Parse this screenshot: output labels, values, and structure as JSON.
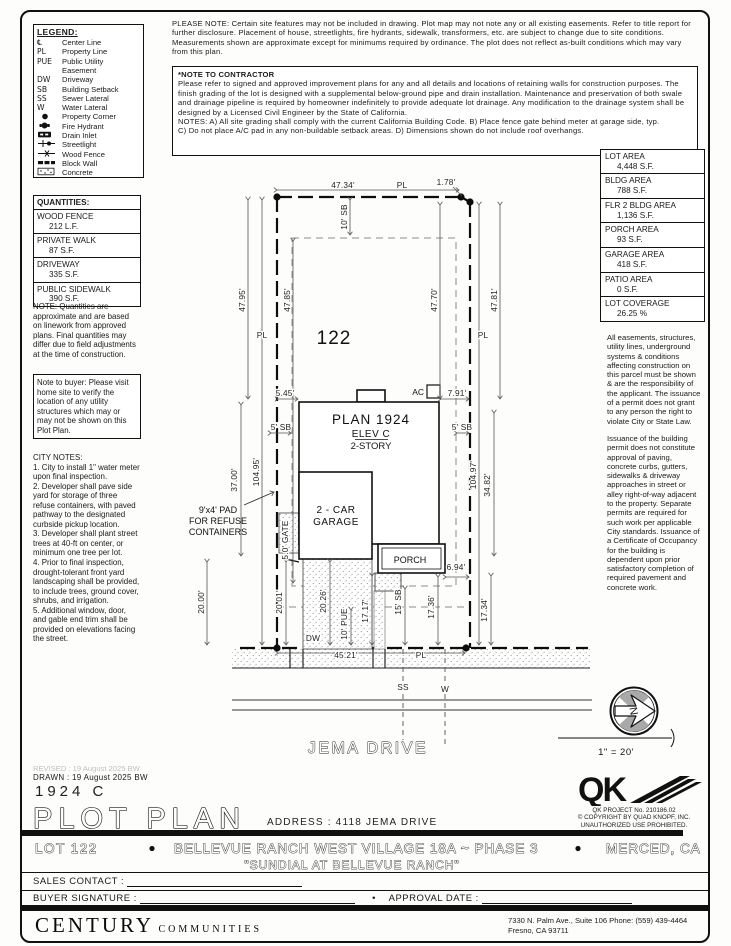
{
  "header": {
    "please_note": "PLEASE NOTE:  Certain site features may not be included in drawing. Plot map may not note any or all existing easements. Refer to title report for further disclosure. Placement of house, streetlights, fire hydrants, sidewalk, transformers, etc. are subject to change due to site conditions. Measurements shown are approximate except for minimums required by ordinance. The plot does not reflect as-built conditions which may vary from this plan.",
    "contractor_note_title": "*NOTE TO CONTRACTOR",
    "contractor_note": "Please refer to signed and approved improvement plans for any and all details and locations of retaining walls for construction purposes. The finish grading of the lot is designed with a supplemental below-ground pipe and drain installation. Maintenance and preservation of both swale and drainage pipeline is required by homeowner indefinitely to provide adequate lot drainage. Any modification to the drainage system shall be designed by a Licensed Civil Engineer by the State of California.\nNOTES:  A) All site grading shall comply with the current California Building Code.  B) Place fence gate behind meter at garage side, typ.\nC) Do not place A/C pad in any non-buildable setback areas.  D) Dimensions shown do not include roof overhangs."
  },
  "legend": {
    "title": "LEGEND:",
    "items": [
      {
        "symbol": "℄",
        "label": "Center Line"
      },
      {
        "symbol": "PL",
        "label": "Property Line"
      },
      {
        "symbol": "PUE",
        "label": "Public Utility\nEasement"
      },
      {
        "symbol": "DW",
        "label": "Driveway"
      },
      {
        "symbol": "SB",
        "label": "Building Setback"
      },
      {
        "symbol": "SS",
        "label": "Sewer Lateral"
      },
      {
        "symbol": "W",
        "label": "Water Lateral"
      },
      {
        "symbol": "",
        "label": "Property Corner"
      },
      {
        "symbol": "",
        "label": "Fire Hydrant"
      },
      {
        "symbol": "",
        "label": "Drain Inlet"
      },
      {
        "symbol": "",
        "label": "Streetlight"
      },
      {
        "symbol": "",
        "label": "Wood Fence"
      },
      {
        "symbol": "",
        "label": "Block Wall"
      },
      {
        "symbol": "",
        "label": "Concrete"
      }
    ]
  },
  "quantities": {
    "title": "QUANTITIES:",
    "items": [
      {
        "label": "WOOD FENCE",
        "value": "212 L.F."
      },
      {
        "label": "PRIVATE WALK",
        "value": "87 S.F."
      },
      {
        "label": "DRIVEWAY",
        "value": "335 S.F."
      },
      {
        "label": "PUBLIC SIDEWALK",
        "value": "390 S.F."
      }
    ],
    "note": "NOTE:  Quantities are approximate and are based on linework from approved plans.  Final quantities may differ due to field adjustments at the time of construction.",
    "buyer_note": "Note to buyer: Please visit home site to verify the location of any utility structures which may or may not be shown on this Plot Plan."
  },
  "city_notes": {
    "title": "CITY NOTES:",
    "body": "1. City to install 1\" water meter upon final inspection.\n2. Developer shall pave side yard for storage of three refuse containers, with paved pathway to the designated curbside pickup location.\n3. Developer shall plant street trees at 40-ft on center, or minimum one tree per lot.\n4. Prior to final inspection, drought-tolerant front yard landscaping shall be provided, to include trees, ground cover, shrubs, and irrigation.\n5. Additional window, door, and gable end trim shall be provided on elevations facing the street."
  },
  "areas": {
    "items": [
      {
        "label": "LOT AREA",
        "value": "4,448 S.F."
      },
      {
        "label": "BLDG AREA",
        "value": "788 S.F."
      },
      {
        "label": "FLR 2 BLDG AREA",
        "value": "1,136 S.F."
      },
      {
        "label": "PORCH AREA",
        "value": "93 S.F."
      },
      {
        "label": "GARAGE AREA",
        "value": "418 S.F."
      },
      {
        "label": "PATIO AREA",
        "value": "0 S.F."
      },
      {
        "label": "LOT COVERAGE",
        "value": "26.25 %"
      }
    ]
  },
  "permit_notes": {
    "para1": "All easements, structures, utility lines, underground systems & conditions affecting construction on this parcel must be shown & are the responsibility of the applicant. The issuance of a permit does not grant to any person the right to violate City or State Law.",
    "para2": "Issuance of the building permit does not constitute approval of paving, concrete curbs, gutters, sidewalks & driveway approaches in street or alley right-of-way adjacent to the property. Separate permits are required for such work per applicable City standards. Issuance of a Certificate of Occupancy for the building is dependent upon prior satisfactory completion of required pavement and concrete work."
  },
  "drawing": {
    "lot_number": "122",
    "plan_name": "PLAN 1924",
    "elev": "ELEV C",
    "story": "2-STORY",
    "garage_l1": "2 - CAR",
    "garage_l2": "GARAGE",
    "porch": "PORCH",
    "refuse_l1": "9'x4' PAD",
    "refuse_l2": "FOR REFUSE",
    "refuse_l3": "CONTAINERS",
    "ac": "AC",
    "gate": "5.0' GATE",
    "dw": "DW",
    "ss": "SS",
    "w": "W",
    "pl": "PL",
    "street": "JEMA DRIVE",
    "north": "N",
    "scale": "1\" = 20'",
    "dims": {
      "top": "47.34'",
      "jog": "1.78'",
      "left_rear": "47.95'",
      "left_rear_in": "47.85'",
      "right_rear_in": "47.70'",
      "right_rear": "47.81'",
      "left_total": "104.95'",
      "right_total": "104.97'",
      "sb_rear": "10' SB",
      "sb_left": "5' SB",
      "sb_right": "5' SB",
      "sb_front": "15' SB",
      "house_left_off": "5.45'",
      "house_right_off": "7.91'",
      "house_depth": "37.00'",
      "front_left": "20.00'",
      "front_left_in": "20.01'",
      "driveway_len": "20.26'",
      "pue": "10' PUE",
      "walk_len": "17.17'",
      "right_mid": "34.82'",
      "porch_front": "17.36'",
      "right_front": "17.34'",
      "porch_side": "6.94'",
      "front_width": "45.21'"
    }
  },
  "title_block": {
    "revised": "REVISED :  19 August 2025  BW",
    "drawn": "DRAWN :  19 August 2025  BW",
    "plan_code": "1924  C",
    "title": "PLOT PLAN",
    "address": "ADDRESS :  4118 JEMA DRIVE",
    "qk_project": "QK PROJECT No. 210186.02",
    "qk_copy1": "© COPYRIGHT BY QUAD KNOPF, INC.",
    "qk_copy2": "UNAUTHORIZED USE PROHIBITED.",
    "lot": "LOT 122",
    "bullet": "•",
    "community": "BELLEVUE RANCH WEST VILLAGE 18A ~ PHASE 3",
    "city": "MERCED, CA",
    "subdivision": "\"SUNDIAL AT BELLEVUE RANCH\"",
    "sales_label": "SALES CONTACT :",
    "buyer_label": "BUYER SIGNATURE :",
    "approval_label": "APPROVAL DATE :"
  },
  "footer": {
    "brand1": "CENTURY",
    "brand2": "COMMUNITIES",
    "address1": "7330 N. Palm Ave., Suite 106   Phone:  (559) 439-4464",
    "address2": "Fresno, CA  93711"
  }
}
